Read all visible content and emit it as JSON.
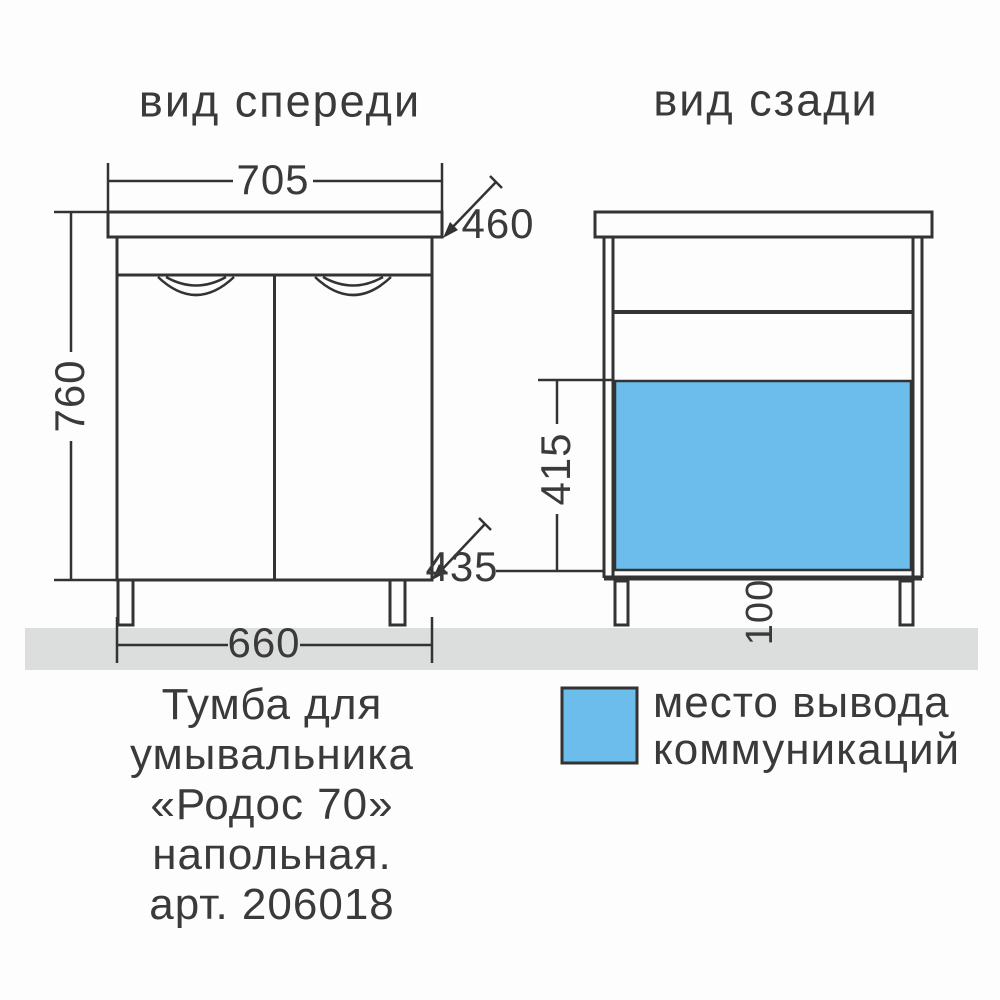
{
  "colors": {
    "highlight_blue": "#6cbdec",
    "floor_gray": "#dcdddd",
    "line": "#333333",
    "text": "#3a3a3a"
  },
  "views": {
    "front": {
      "title": "вид спереди",
      "dimensions": {
        "top_width": "705",
        "top_depth": "460",
        "height": "760",
        "bottom_depth": "435",
        "bottom_width": "660"
      }
    },
    "back": {
      "title": "вид сзади",
      "dimensions": {
        "outlet_zone_height": "415",
        "leg_height": "100"
      }
    }
  },
  "legend": {
    "line1": "место вывода",
    "line2": "коммуникаций"
  },
  "caption": {
    "line1": "Тумба для",
    "line2": "умывальника",
    "line3": "«Родос 70»",
    "line4": "напольная.",
    "line5": "арт. 206018"
  }
}
